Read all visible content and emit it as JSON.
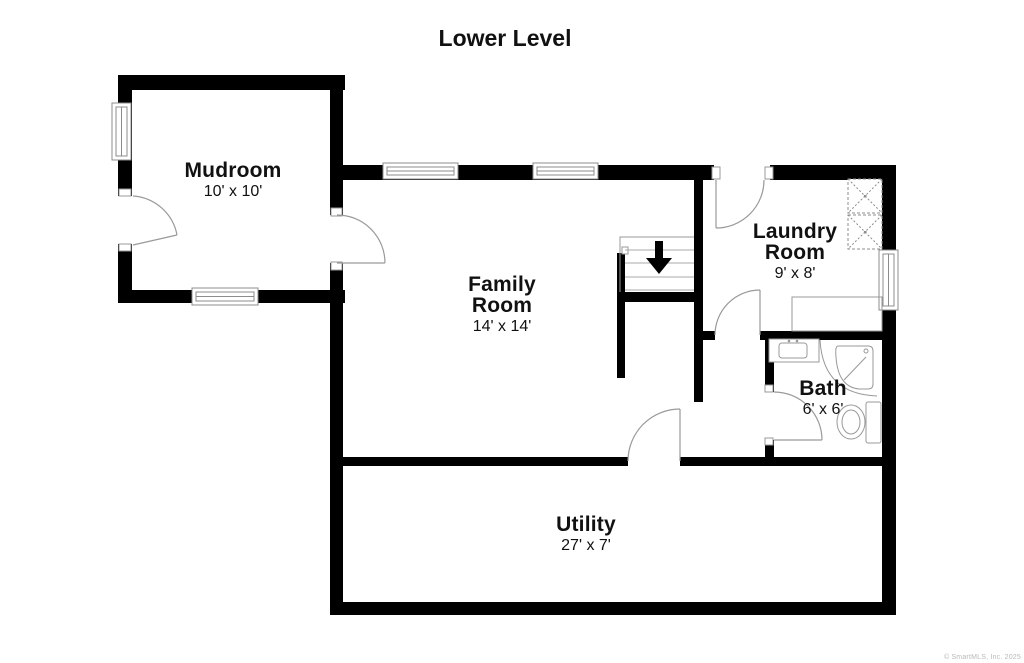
{
  "plan": {
    "title": "Lower Level"
  },
  "rooms": [
    {
      "id": "mudroom",
      "name": "Mudroom",
      "dims": "10' x 10'"
    },
    {
      "id": "family",
      "name": "Family Room",
      "dims": "14' x 14'"
    },
    {
      "id": "laundry",
      "name": "Laundry Room",
      "dims": "9' x 8'"
    },
    {
      "id": "bath",
      "name": "Bath",
      "dims": "6' x 6'"
    },
    {
      "id": "utility",
      "name": "Utility",
      "dims": "27' x 7'"
    }
  ],
  "fixtures": [
    "stairs-down-arrow",
    "washer",
    "dryer",
    "laundry-counter",
    "bath-sink",
    "corner-shower",
    "toilet",
    "window-mudroom-left",
    "window-mudroom-bottom",
    "window-family-1",
    "window-family-2",
    "window-laundry-right",
    "door-mudroom-exterior",
    "door-mudroom-family",
    "door-laundry-top",
    "door-laundry-hall",
    "door-bath",
    "door-utility"
  ],
  "colors": {
    "wall": "#000000",
    "fixture_line": "#999999",
    "text": "#111111",
    "background": "#ffffff",
    "watermark": "#b9b9b9"
  },
  "footer": {
    "copyright": "© SmartMLS, Inc. 2025"
  }
}
